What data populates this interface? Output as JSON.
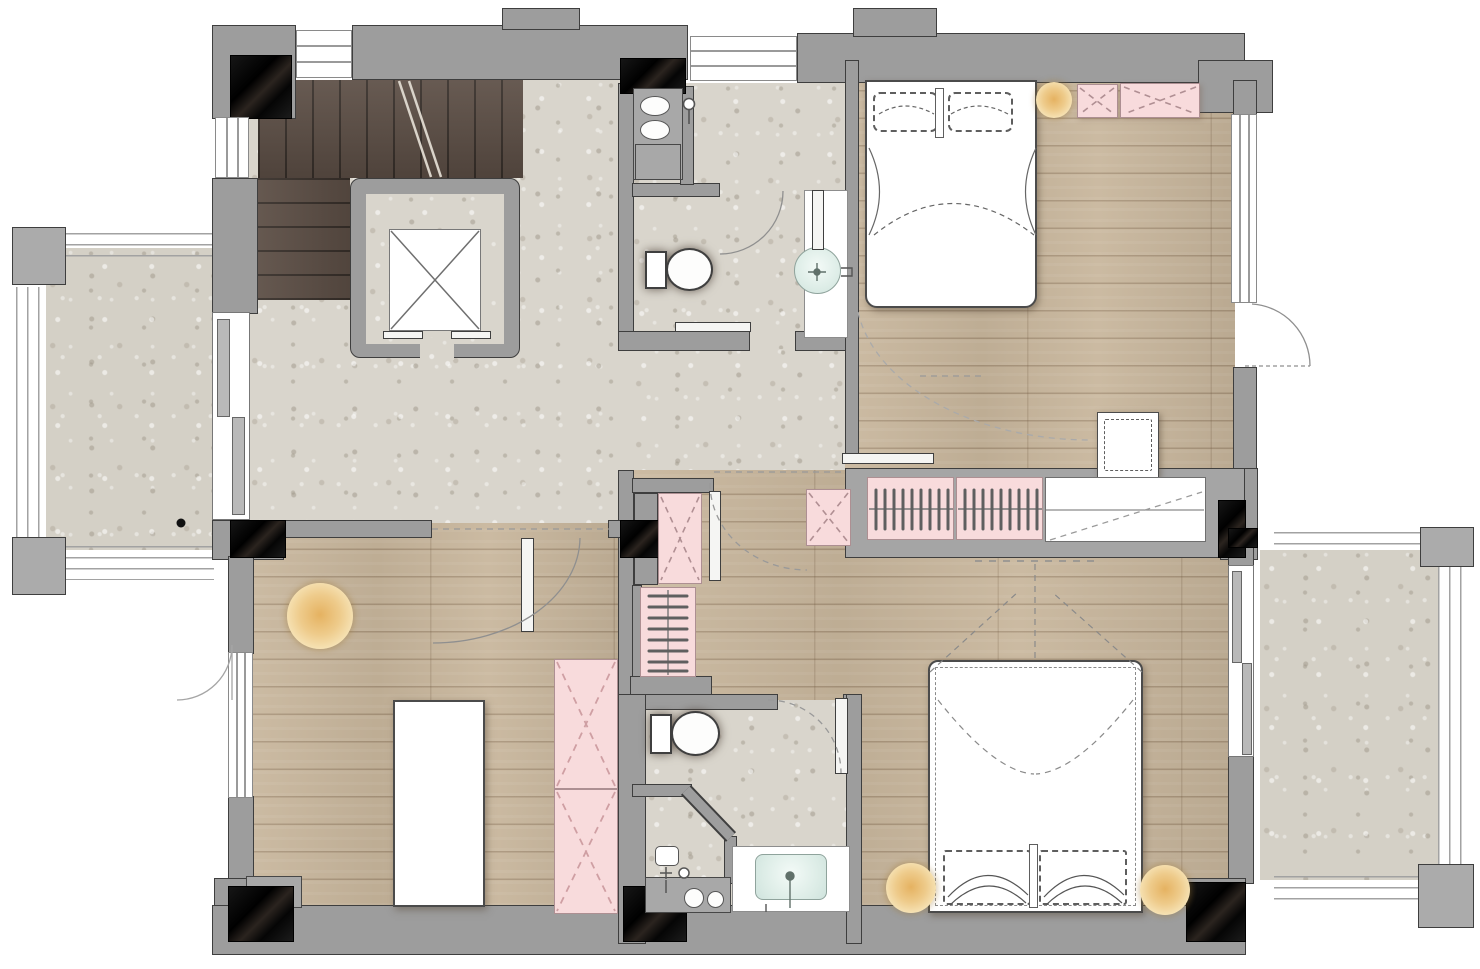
{
  "plan": {
    "type": "residential apartment floor plan, top-down view",
    "palette": {
      "wall_fill": "#9d9d9d",
      "wall_outline": "#3e3e3e",
      "marble_column": "#141414",
      "stone_floor": "#d9d5cc",
      "wood_floor": "#c8b69c",
      "stair_wood": "#5c4e45",
      "cabinet_pink": "#f8dbdc",
      "lamp_yellow": "#eecb8b",
      "basin_teal": "#dcebe5",
      "furniture_white": "#ffffff"
    },
    "rooms": {
      "hall": {
        "name": "entry hall",
        "floor": "terrazzo stone"
      },
      "stairs": {
        "name": "staircase",
        "floor": "dark wood treads"
      },
      "elevator": {
        "name": "elevator shaft",
        "symbol": "square with X brace"
      },
      "bathroom_top": {
        "name": "upper bathroom",
        "fixtures": [
          "laundry counter with twin oval basins",
          "wall faucet",
          "toilet",
          "round washbasin on white vanity",
          "swing door",
          "sliding door"
        ]
      },
      "bedroom_top_right": {
        "name": "bedroom 1",
        "furniture": [
          "double bed with two pillows",
          "bedside lamp",
          "small pink cabinet",
          "wide pink cabinet",
          "white dresser",
          "sliding entry door",
          "exterior swing door",
          "window"
        ]
      },
      "wardrobe_wall": {
        "name": "built-in wardrobe run",
        "furniture": [
          "hanging section A",
          "hanging section B",
          "white linen cabinet",
          "small pink storage box"
        ]
      },
      "corridor": {
        "name": "inner corridor",
        "furniture": [
          "pink cabinet",
          "open hanging closet",
          "swing door",
          "sliding leaf"
        ]
      },
      "bedroom_bottom_left": {
        "name": "bedroom 2",
        "furniture": [
          "round floor lamp",
          "long white table",
          "two-section pink wardrobe",
          "entry swing door",
          "window",
          "exterior door"
        ]
      },
      "bathroom_bottom": {
        "name": "lower bathroom",
        "fixtures": [
          "toilet",
          "angled shower screen",
          "shower mixer",
          "utility counter with two round hookups",
          "vanity with rectangular teal basin",
          "swing door"
        ]
      },
      "bedroom_bottom_right": {
        "name": "bedroom 3",
        "furniture": [
          "double bed with two pillows",
          "left bedside lamp",
          "right bedside lamp",
          "sliding balcony door"
        ]
      },
      "balcony_left": {
        "name": "west balcony",
        "features": [
          "stone paving",
          "perimeter railing",
          "two concrete pillars"
        ]
      },
      "balcony_right": {
        "name": "east balcony",
        "features": [
          "stone paving",
          "perimeter railing",
          "two concrete pillars"
        ]
      }
    }
  }
}
